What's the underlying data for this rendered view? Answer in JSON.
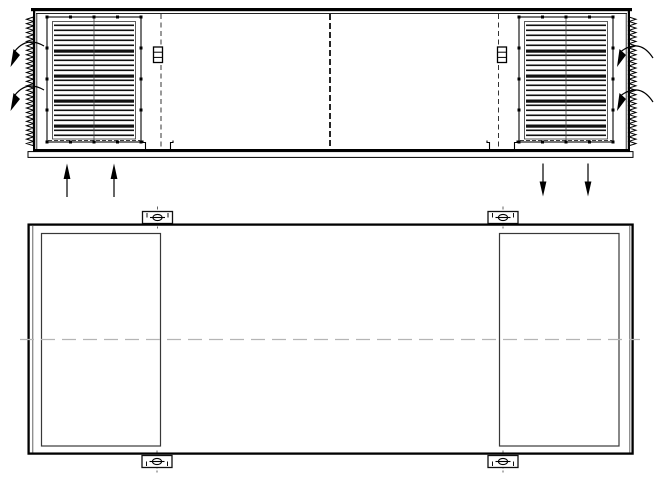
{
  "drawing": {
    "background_color": "#ffffff",
    "stroke_color": "#000000",
    "centerline_color": "#b5b5b5",
    "views": {
      "elevation": {
        "name": "unit-elevation-view",
        "louvers": {
          "count": 2,
          "slats_per_louver": 23,
          "thick_slat_every": 5,
          "fastener_dots_per_louver": 16
        },
        "gasket_strips": {
          "count": 2,
          "teeth_per_strip": 29
        },
        "section_break_lines": 3,
        "hinge_blocks": 2,
        "floor_channels": 2,
        "airflow_arrows": {
          "curved_left_count": 2,
          "curved_right_count": 2,
          "straight_up_count": 2,
          "straight_down_count": 2
        }
      },
      "plan": {
        "name": "unit-plan-view",
        "access_panels": 2,
        "lifting_brackets": 4,
        "bracket_hole_symbol": "circle-with-slot",
        "horizontal_centerlines": 1
      }
    }
  }
}
